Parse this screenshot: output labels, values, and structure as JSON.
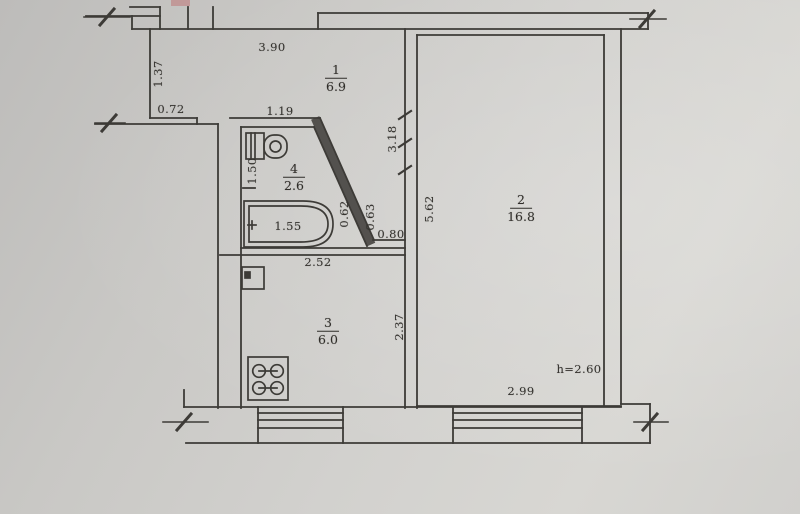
{
  "document": {
    "kind": "apartment floor plan (scanned technical passport drawing)",
    "ceiling_height_note": "h=2.60"
  },
  "rooms": [
    {
      "id": "hall",
      "number": "1",
      "area": "6.9"
    },
    {
      "id": "living-room",
      "number": "2",
      "area": "16.8"
    },
    {
      "id": "kitchen",
      "number": "3",
      "area": "6.0"
    },
    {
      "id": "bathroom",
      "number": "4",
      "area": "2.6"
    }
  ],
  "dimensions": {
    "hall_width": "3.90",
    "entry_niche_depth": "1.37",
    "niche_bottom_wall": "0.72",
    "bathroom_top_width": "1.19",
    "hall_right_side": "3.18",
    "bathroom_left_side": "1.50",
    "bathtub_length": "1.55",
    "tub_end_gap": "0.62",
    "diagonal_wall": "0.63",
    "passage_width": "0.80",
    "living_room_depth": "5.62",
    "kitchen_top_width": "2.52",
    "kitchen_right_side": "2.37",
    "living_room_width": "2.99"
  },
  "fixtures": [
    "toilet",
    "bathtub",
    "kitchen-sink",
    "stove"
  ],
  "colors": {
    "paper": "#cfcecb",
    "ink": "#3d3b37",
    "red_stamp": "#c08b8b"
  }
}
